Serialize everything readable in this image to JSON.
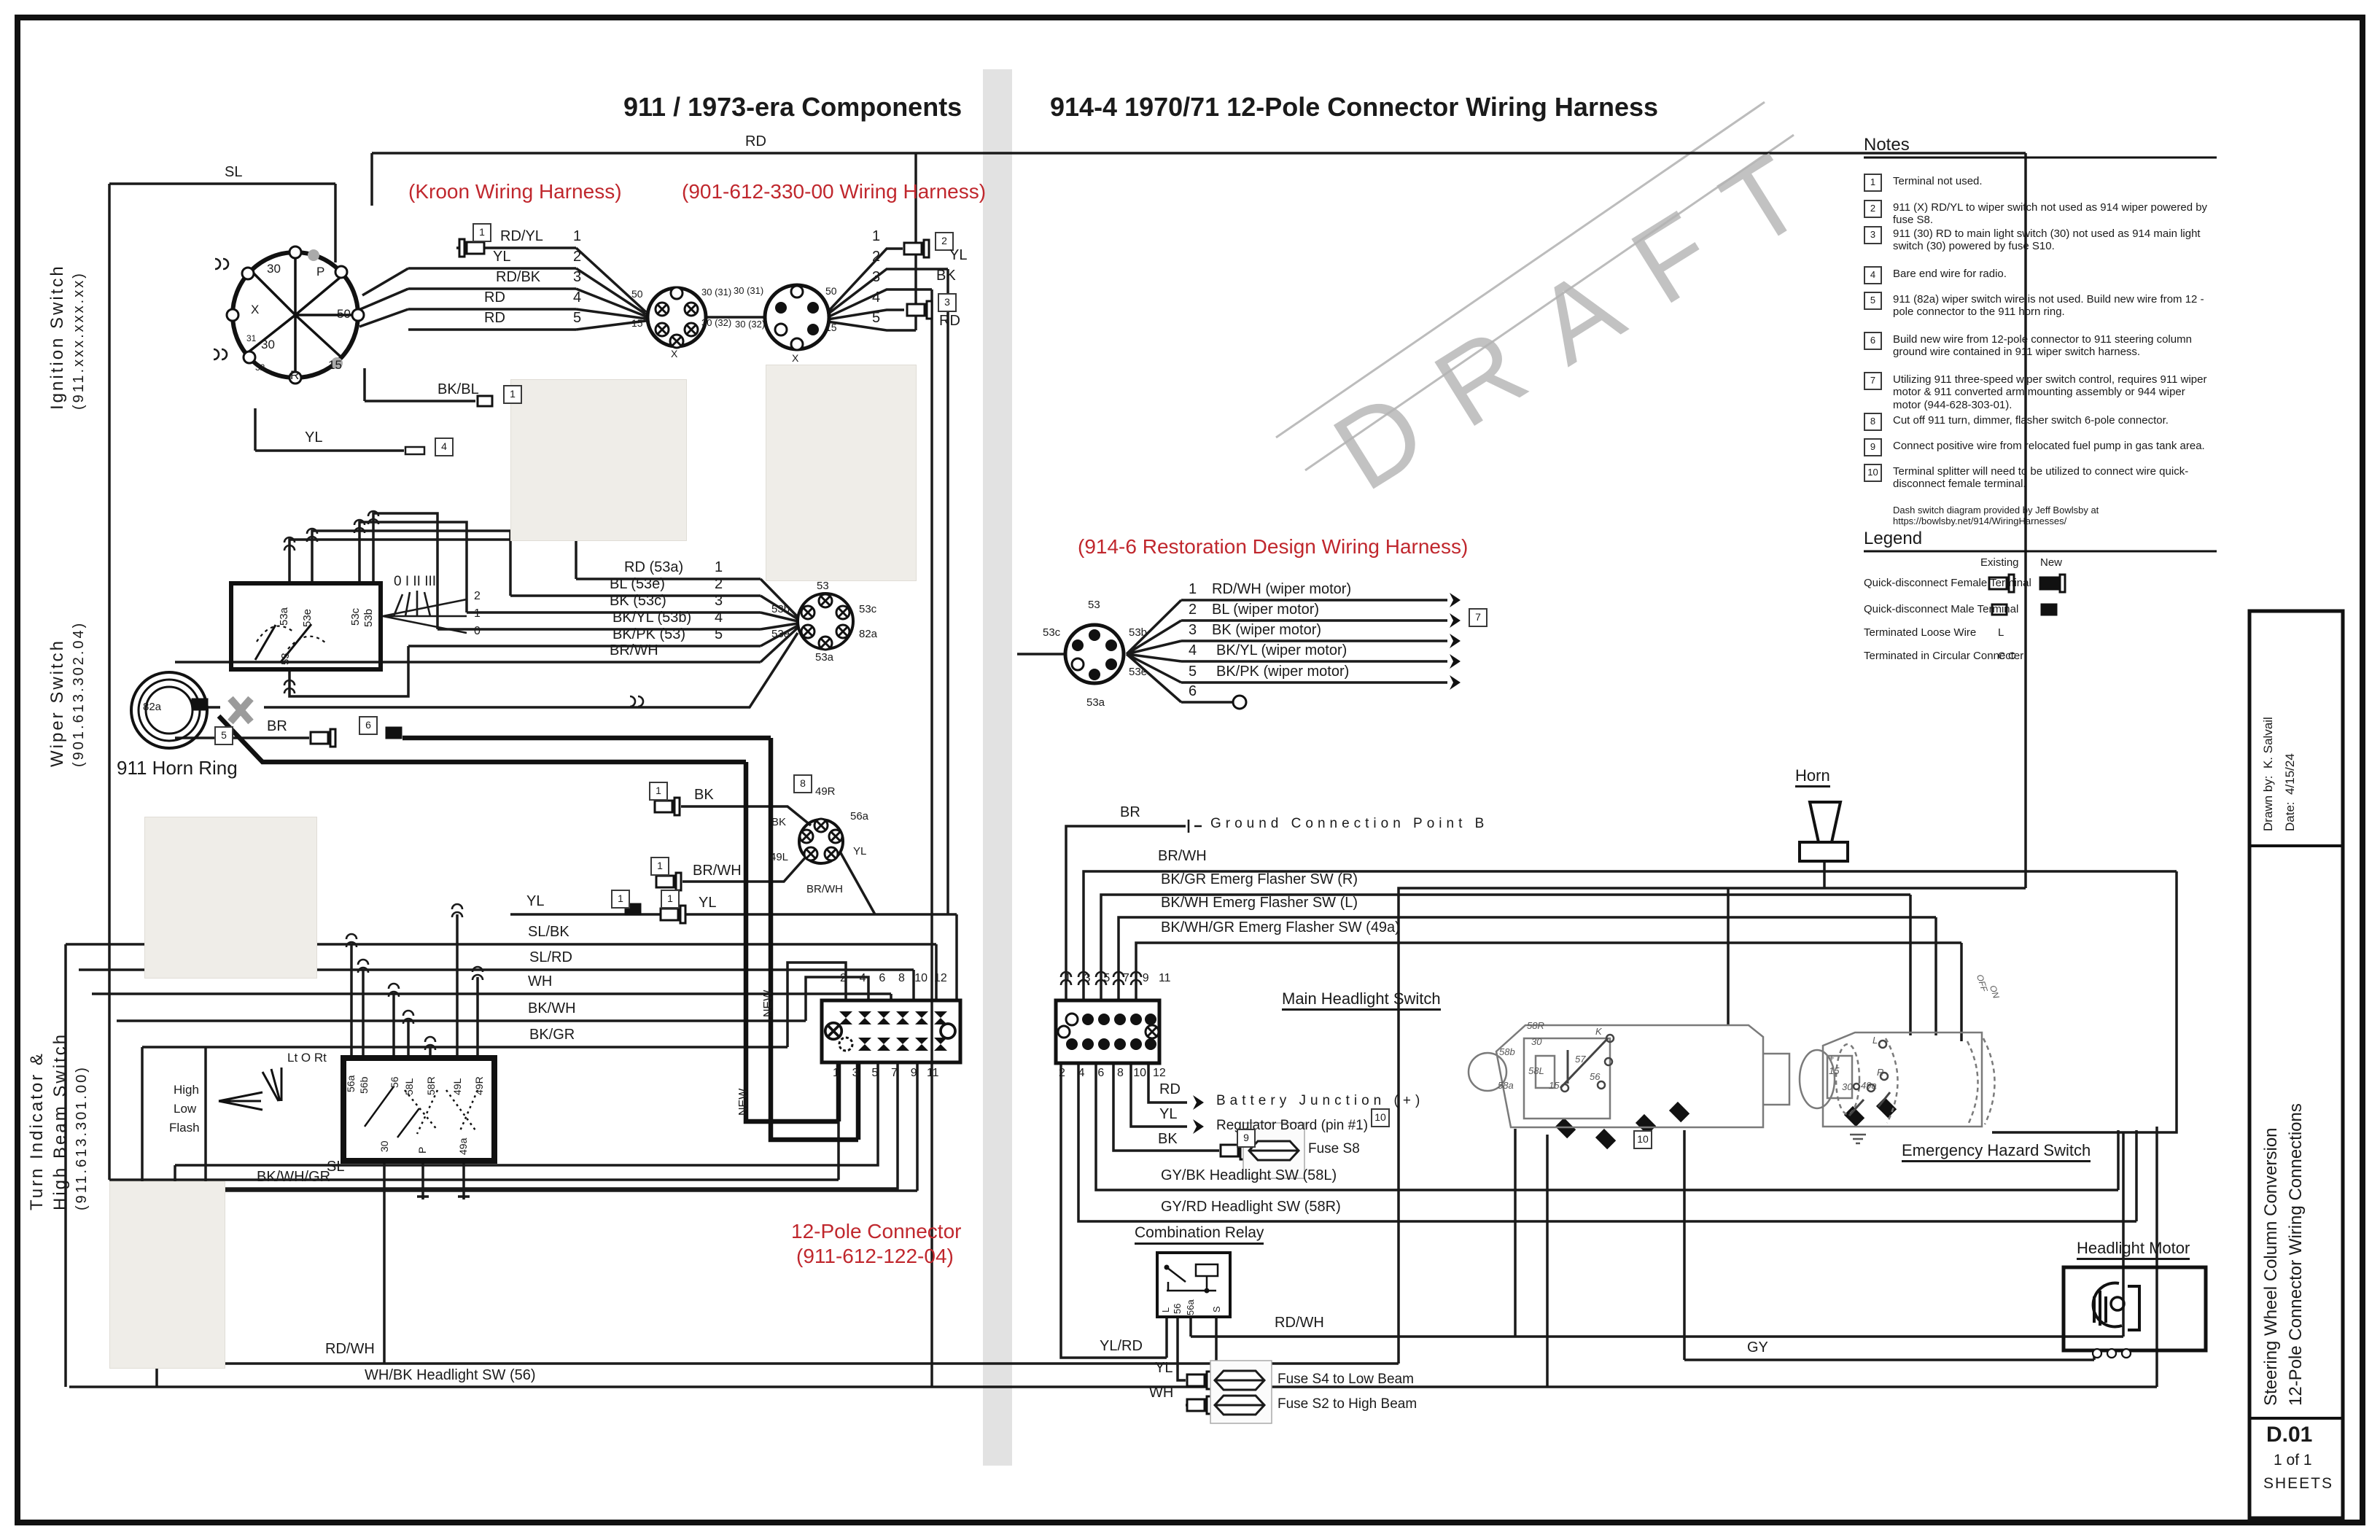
{
  "titles": {
    "left": "911 / 1973-era Components",
    "right": "914-4 1970/71 12-Pole Connector Wiring Harness"
  },
  "red": {
    "kroon": "(Kroon Wiring Harness)",
    "h901": "(901-612-330-00 Wiring Harness)",
    "h914": "(914-6 Restoration Design Wiring Harness)",
    "p12a": "12-Pole Connector",
    "p12b": "(911-612-122-04)"
  },
  "watermark": "DRAFT",
  "side": {
    "ign1": "Ignition Switch",
    "ign2": "(911.xxx.xxx.xx)",
    "wip1": "Wiper Switch",
    "wip2": "(901.613.302.04)",
    "turn1": "Turn Indicator &",
    "turn2": "High Beam Switch",
    "turn3": "(911.613.301.00)"
  },
  "notes": {
    "title": "Notes",
    "items": [
      {
        "n": "1",
        "t": "Terminal not used."
      },
      {
        "n": "2",
        "t": "911 (X) RD/YL to wiper switch not used as 914 wiper powered by fuse S8."
      },
      {
        "n": "3",
        "t": "911 (30) RD to main light switch (30) not used as 914 main light switch (30) powered by fuse S10."
      },
      {
        "n": "4",
        "t": "Bare end wire for radio."
      },
      {
        "n": "5",
        "t": "911 (82a) wiper switch wire is not used.  Build new wire from 12 -pole connector to the 911 horn ring."
      },
      {
        "n": "6",
        "t": "Build new wire from 12-pole connector to 911 steering column ground wire contained in 911 wiper switch harness."
      },
      {
        "n": "7",
        "t": "Utilizing 911 three-speed wiper switch control, requires 911 wiper motor & 911 converted arm mounting assembly or 944 wiper motor (944-628-303-01)."
      },
      {
        "n": "8",
        "t": "Cut off 911 turn, dimmer, flasher switch 6-pole connector."
      },
      {
        "n": "9",
        "t": "Connect positive wire from relocated fuel pump in gas tank area."
      },
      {
        "n": "10",
        "t": "Terminal splitter will need to be utilized to connect wire quick-disconnect female terminal."
      }
    ],
    "credit": "Dash switch diagram provided by Jeff Bowlsby at https://bowlsby.net/914/WiringHarnesses/"
  },
  "legend": {
    "title": "Legend",
    "existing": "Existing",
    "new_col": "New",
    "r1": "Quick-disconnect Female Terminal",
    "r2": "Quick-disconnect Male Terminal",
    "r3": "Terminated Loose Wire",
    "r4": "Terminated in Circular Connecter",
    "sym_l": "L",
    "sym_cc": "C C"
  },
  "tb": {
    "by": "Drawn by:  K. Salvail",
    "date": "Date:  4/15/24",
    "t1": "Steering Wheel Column Conversion",
    "t2": "12-Pole Connector Wiring Connections",
    "code": "D.01",
    "page": "1 of 1",
    "sheets": "SHEETS"
  },
  "w": {
    "sl": "SL",
    "rd": "RD",
    "rdyl": "RD/YL",
    "yl": "YL",
    "rdbk": "RD/BK",
    "bkbl": "BK/BL",
    "bk": "BK",
    "br": "BR",
    "brwh": "BR/WH",
    "slbk": "SL/BK",
    "slrd": "SL/RD",
    "wh": "WH",
    "bkwh": "BK/WH",
    "bkgr": "BK/GR",
    "bkwhgr": "BK/WH/GR",
    "rdwh": "RD/WH",
    "ylrd": "YL/RD",
    "gy": "GY",
    "rd53a": "RD (53a)",
    "bl53e": "BL (53e)",
    "bk53c": "BK (53c)",
    "bkyl53b": "BK/YL (53b)",
    "bkpk53": "BK/PK (53)",
    "rdwh_wm": "RD/WH (wiper motor)",
    "bl_wm": "BL (wiper motor)",
    "bk_wm": "BK (wiper motor)",
    "bkyl_wm": "BK/YL (wiper motor)",
    "bkpk_wm": "BK/PK (wiper motor)",
    "bkgr_ef": "BK/GR Emerg Flasher SW (R)",
    "bkwh_ef": "BK/WH Emerg Flasher SW (L)",
    "bkwhgr_ef": "BK/WH/GR Emerg Flasher SW (49a)",
    "gybk": "GY/BK Headlight SW (58L)",
    "gyrd": "GY/RD Headlight SW (58R)",
    "whbk": "WH/BK Headlight SW (56)"
  },
  "t": {
    "t30": "30",
    "tp": "P",
    "tx": "X",
    "t50": "50",
    "t15": "15",
    "t31": "31",
    "t32": "32",
    "tr": "R",
    "t3031": "30 (31)",
    "t3032": "30 (32)",
    "t53": "53",
    "t53a": "53a",
    "t53b": "53b",
    "t53c": "53c",
    "t53e": "53e",
    "t82a": "82a",
    "t49r": "49R",
    "t49l": "49L",
    "t56a": "56a",
    "t56b": "56b",
    "t56": "56",
    "t58l": "58L",
    "t58r": "58R",
    "t49a": "49a",
    "t58b": "58b",
    "t58a": "58a",
    "t57": "57",
    "tk": "K",
    "tl": "L",
    "ts": "S",
    "tplus": "+"
  },
  "nb": {
    "n1": "1",
    "n2": "2",
    "n3": "3",
    "n4": "4",
    "n5": "5",
    "n6": "6",
    "n7": "7",
    "n8": "8",
    "n9": "9",
    "n10": "10"
  },
  "pins": {
    "p0": "0",
    "p1": "1",
    "p2": "2",
    "p3": "3",
    "p4": "4",
    "p5": "5",
    "p6": "6",
    "p7": "7",
    "p8": "8",
    "p9": "9",
    "p10": "10",
    "p11": "11",
    "p12": "12",
    "evens": "2    4    6    8   10  12",
    "odds": "1    3    5    7    9   11"
  },
  "misc": {
    "ground": "Ground Connection Point B",
    "battery": "Battery Junction (+)",
    "regulator": "Regulator Board (pin #1)",
    "fuse_s8": "Fuse S8",
    "fuse_s4": "Fuse S4 to Low Beam",
    "fuse_s2": "Fuse S2 to High Beam",
    "relay": "Combination Relay",
    "mhs": "Main Headlight Switch",
    "hazard": "Emergency Hazard Switch",
    "motor": "Headlight Motor",
    "horn": "Horn",
    "horn_ring": "911 Horn Ring",
    "new_lbl": "NEW",
    "positions": "0 I II III",
    "lt": "Lt O Rt",
    "high": "High",
    "low": "Low",
    "flash": "Flash",
    "off": "OFF",
    "on": "ON"
  }
}
